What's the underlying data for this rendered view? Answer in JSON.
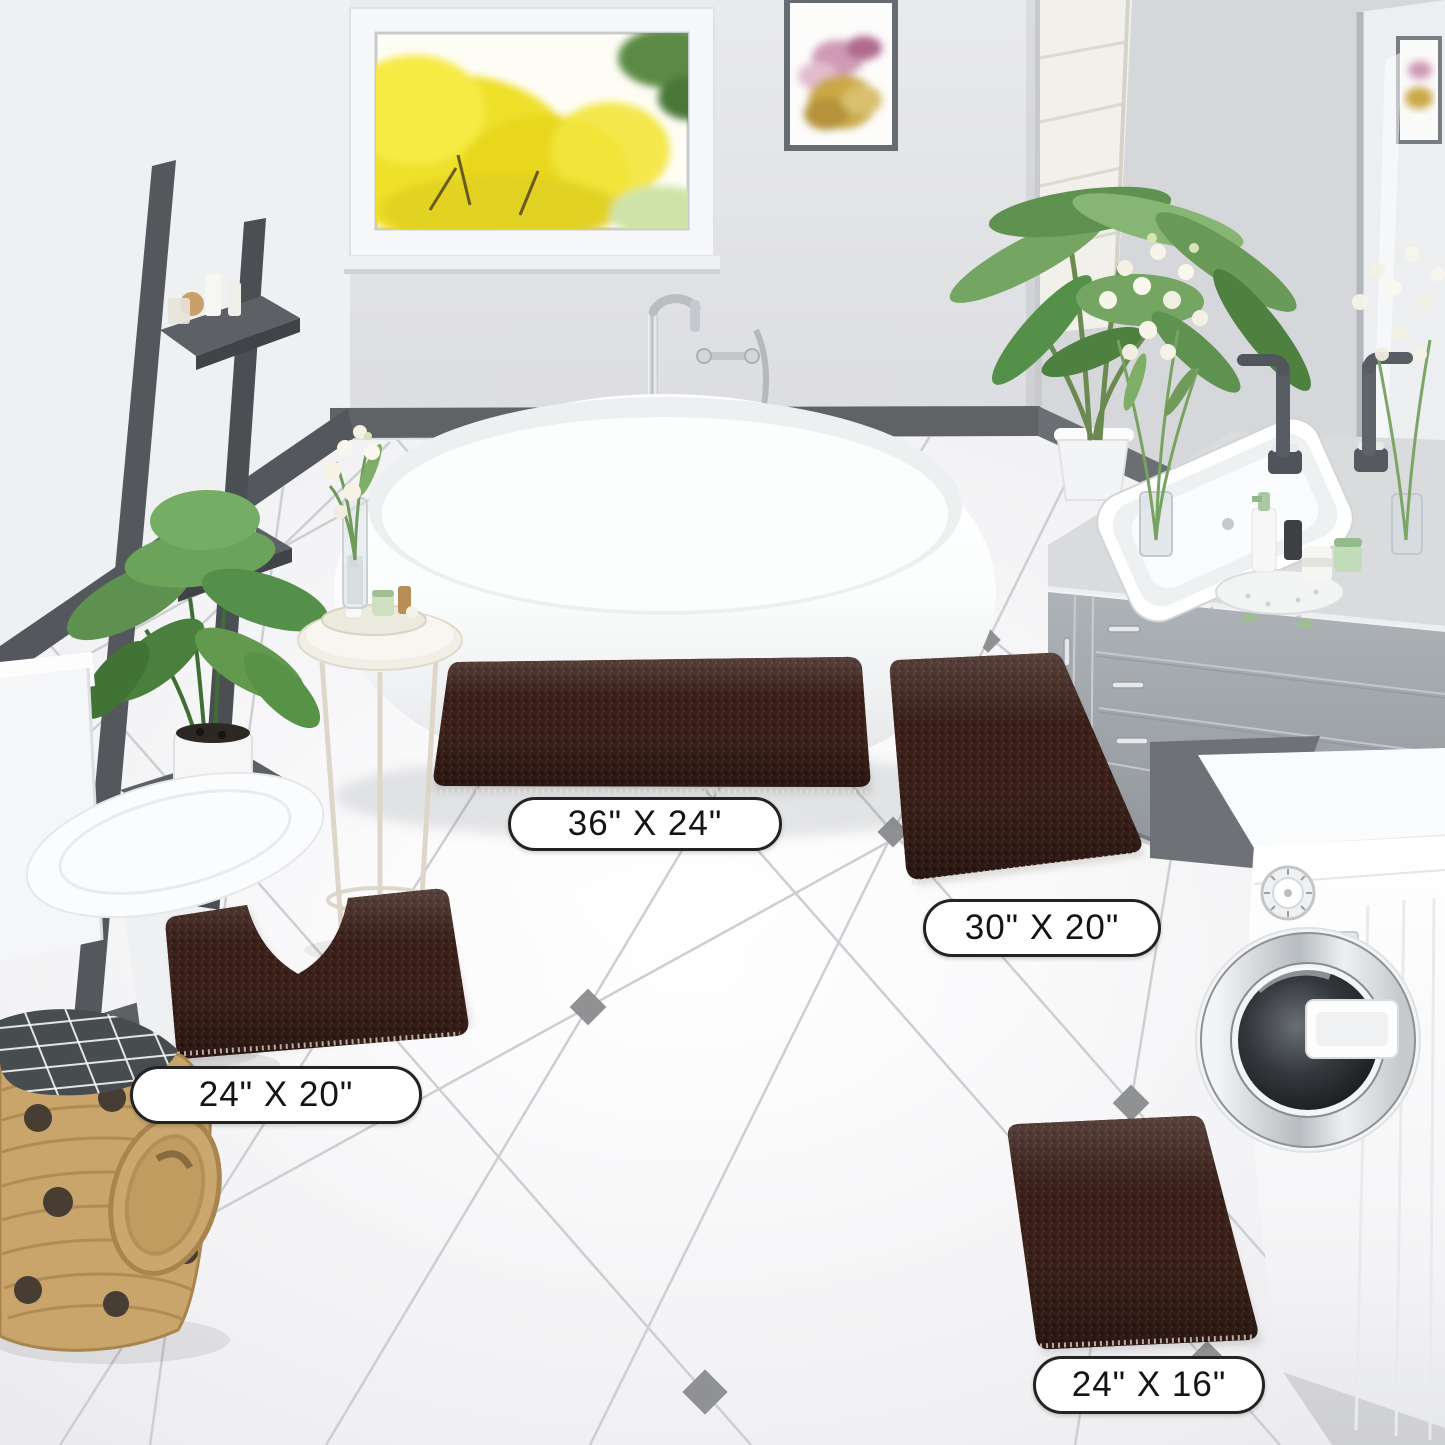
{
  "rugs": [
    {
      "name": "rectangular-rug-large",
      "size_label": "36\" X 24\""
    },
    {
      "name": "rectangular-rug-medium",
      "size_label": "30\" X 20\""
    },
    {
      "name": "contour-rug",
      "size_label": "24\" X 20\""
    },
    {
      "name": "rectangular-rug-small",
      "size_label": "24\" X 16\""
    }
  ],
  "colors": {
    "rug": "#3a211b",
    "rug_highlight": "#4a2c22",
    "label_background": "#ffffff",
    "label_border": "#232323",
    "label_text": "#141414",
    "wall": "#dcdde0",
    "floor": "#f6f6f8",
    "tile_accent": "#8f9193",
    "baseboard": "#55595d",
    "ladder": "#53575b",
    "vanity": "#a7acb0",
    "basket": "#c9a56b",
    "foliage": "#6a9a58",
    "window_tree_yellow": "#f0e12c"
  }
}
